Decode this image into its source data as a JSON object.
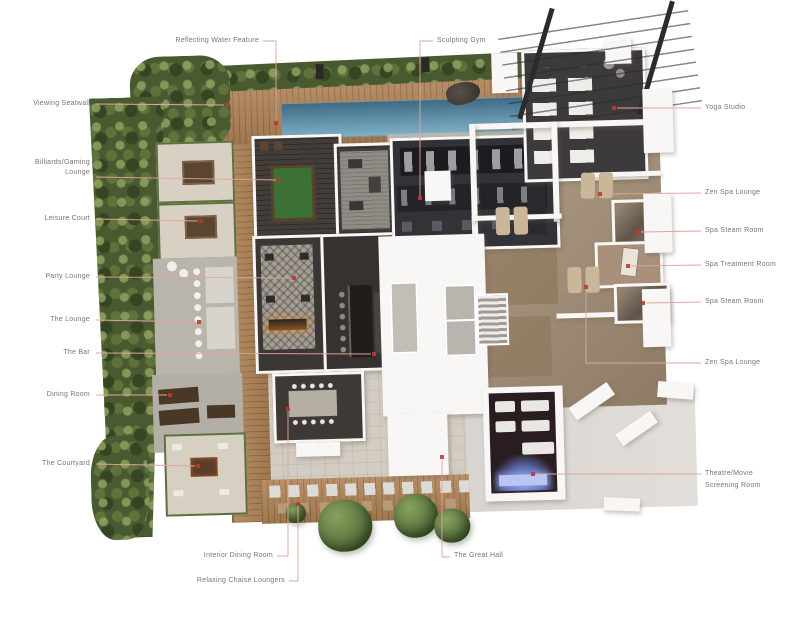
{
  "figure": {
    "kind": "amenity-floor-plan-rendering",
    "labels": {
      "reflecting_water_feature": "Reflecting Water Feature",
      "sculpting_gym": "Sculpting Gym",
      "viewing_seatwall": "Viewing Seatwall",
      "billiards_gaming_lounge": "Billiards/Gaming Lounge",
      "leisure_court": "Leisure Court",
      "party_lounge": "Party Lounge",
      "the_lounge": "The Lounge",
      "the_bar": "The Bar",
      "dining_room": "Dining Room",
      "the_courtyard": "The Courtyard",
      "yoga_studio": "Yoga Studio",
      "zen_spa_lounge_upper": "Zen Spa Lounge",
      "spa_steam_room_upper": "Spa Steam Room",
      "spa_treatment_room": "Spa Treatment Room",
      "spa_steam_room_lower": "Spa Steam Room",
      "zen_spa_lounge_lower": "Zen Spa Lounge",
      "theatre_movie_screening_room": "Theatre/Movie Screening Room",
      "interior_dining_room": "Interior Dining Room",
      "relaxing_chaise_loungers": "Relaxing Chaise Loungers",
      "the_great_hall": "The Great Hall"
    },
    "palette": {
      "leader_line": "#dfa69d",
      "marker_dot": "#bf3a2b",
      "label_text": "#7b7570",
      "wood_deck": "#b08457",
      "pool_water": "#5d89a3",
      "landscape_green": "#4a5a30",
      "dark_interior_floor": "#3a3634",
      "stone_floor": "#d2ccc2",
      "spa_floor": "#a28b70",
      "concrete_slab": "#dcd9d5",
      "billiards_felt": "#3b7134",
      "theatre_screen_glow": "#8fa0e8",
      "walls": "#f8f7f5"
    }
  }
}
